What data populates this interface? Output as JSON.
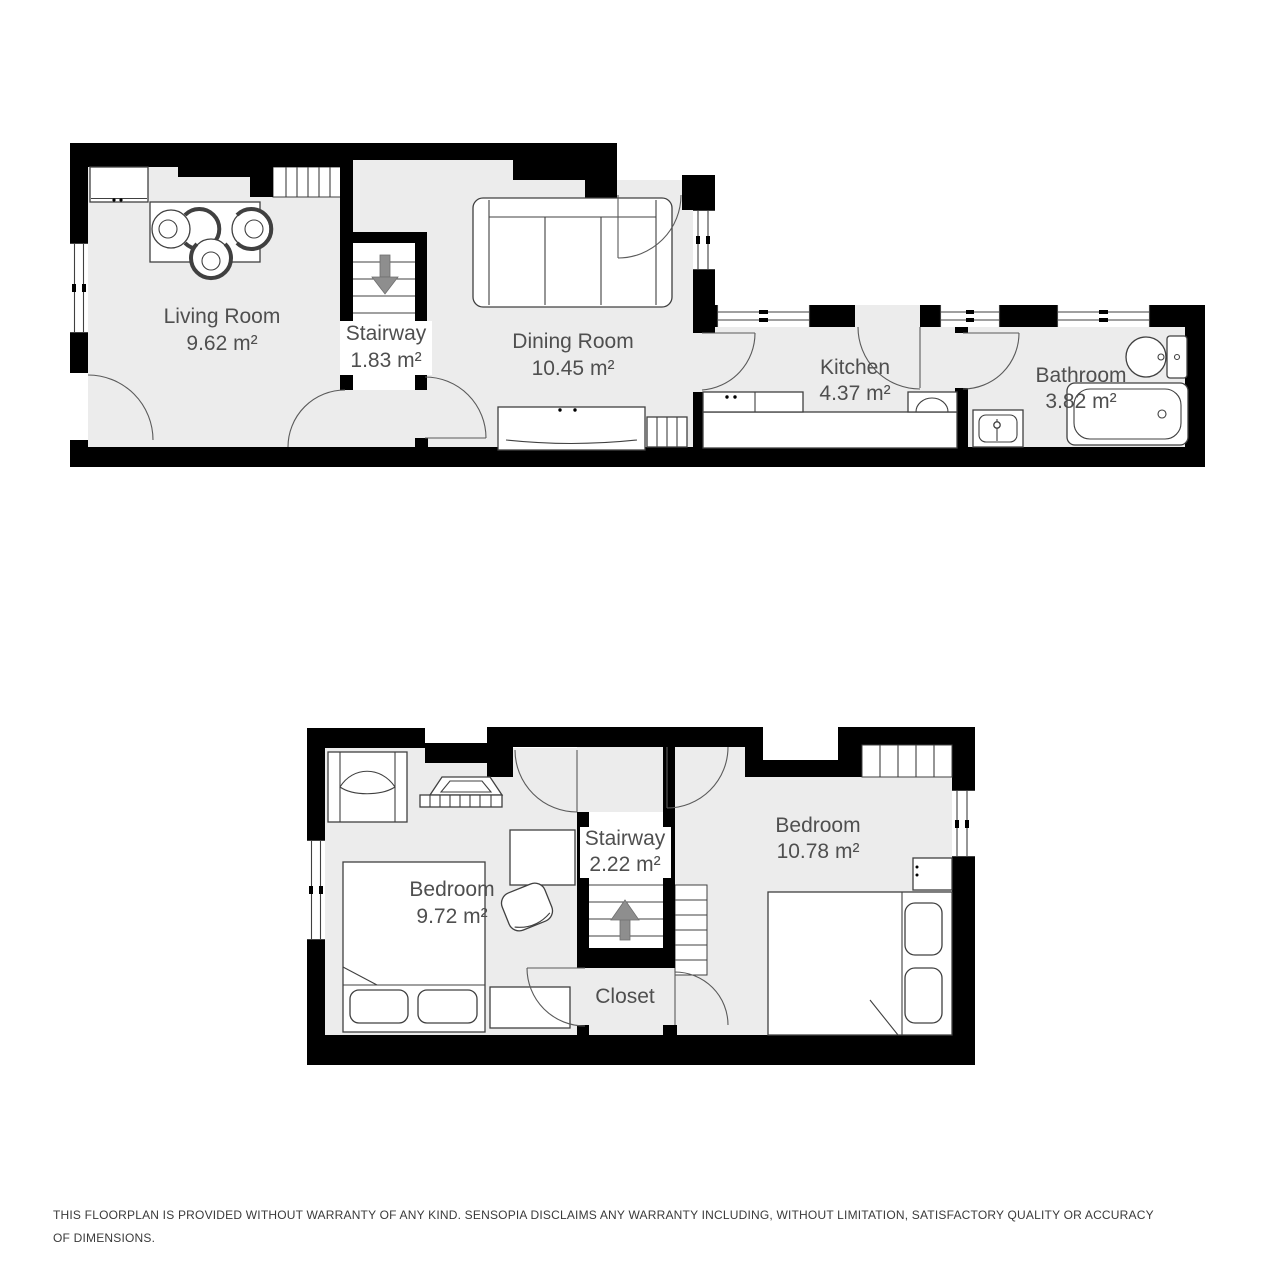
{
  "floors": [
    {
      "id": "ground-floor",
      "rooms": [
        {
          "label": "Living Room",
          "area": "9.62 m²"
        },
        {
          "label": "Stairway",
          "area": "1.83 m²"
        },
        {
          "label": "Dining Room",
          "area": "10.45 m²"
        },
        {
          "label": "Kitchen",
          "area": "4.37 m²"
        },
        {
          "label": "Bathroom",
          "area": "3.82 m²"
        }
      ]
    },
    {
      "id": "upper-floor",
      "rooms": [
        {
          "label": "Bedroom",
          "area": "9.72 m²"
        },
        {
          "label": "Stairway",
          "area": "2.22 m²"
        },
        {
          "label": "Bedroom",
          "area": "10.78 m²"
        },
        {
          "label": "Closet"
        }
      ]
    }
  ],
  "disclaimer": "THIS FLOORPLAN IS PROVIDED WITHOUT WARRANTY OF ANY KIND. SENSOPIA DISCLAIMS ANY WARRANTY INCLUDING, WITHOUT LIMITATION, SATISFACTORY QUALITY OR ACCURACY OF DIMENSIONS.",
  "colors": {
    "wall": "#000000",
    "room_fill": "#ececec",
    "line": "#404040",
    "label_text": "#4f4f4f",
    "arrow": "#8e8e8e",
    "disclaimer_text": "#3a3a3a",
    "bg": "#ffffff"
  }
}
